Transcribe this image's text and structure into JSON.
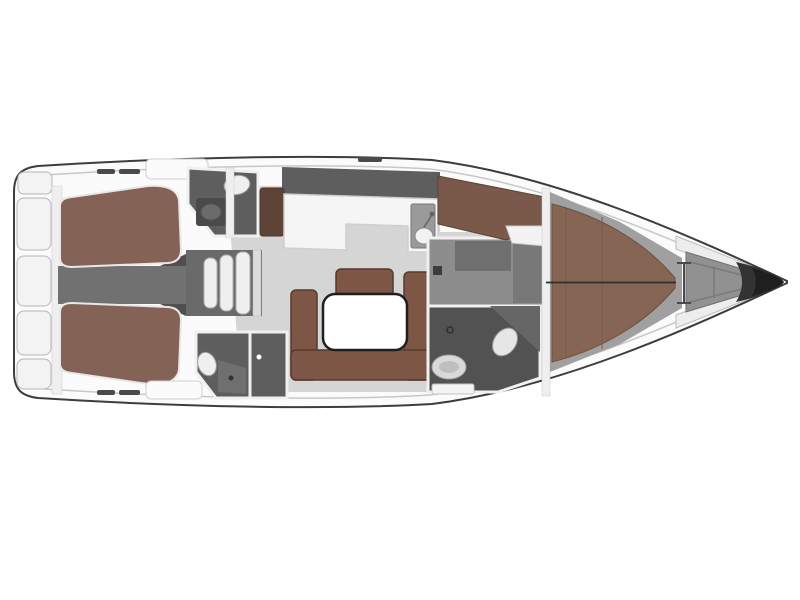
{
  "figure": {
    "kind": "yacht-interior-floorplan",
    "orientation": "bow-right",
    "visible_text": []
  },
  "palette": {
    "background": "#ffffff",
    "hull_fill": "#fbfbfb",
    "hull_outline": "#3d3d3d",
    "deck_line": "#c8c8c8",
    "seat_fill": "#f3f3f3",
    "seat_stroke": "#b5b5b5",
    "floor_gray": "#d5d5d5",
    "corridor_gray": "#717171",
    "stairs_gray": "#6a6a6a",
    "room_dark": "#5e5e5e",
    "room_darker": "#525252",
    "room_medium": "#8d8d8d",
    "inner_dark": "#6f6f6f",
    "berth_brown": "#846356",
    "sofa_brown": "#7d5646",
    "bed_brown": "#876555",
    "band_brown": "#7a584a",
    "bench_brown": "#5e4337",
    "white_furniture": "#f5f5f5",
    "fixture_white": "#efefef",
    "fixture_gray": "#d9d9d9",
    "sink_gray": "#9a9a9a",
    "sink_dark": "#4a4a4a",
    "locker_gray": "#919191",
    "tip_dark": "#333333",
    "tip_core": "#1f1f1f",
    "slot_dark": "#4a4a4a",
    "table_white": "#ffffff",
    "wall_white": "#efefef"
  },
  "regions": [
    {
      "name": "transom-bench-seats",
      "fill": "seat_fill"
    },
    {
      "name": "aft-cabin-port-berth",
      "fill": "berth_brown"
    },
    {
      "name": "aft-cabin-starboard-berth",
      "fill": "berth_brown"
    },
    {
      "name": "engine-corridor",
      "fill": "corridor_gray"
    },
    {
      "name": "companionway-stairs",
      "fill": "stairs_gray"
    },
    {
      "name": "head-aft-port",
      "fill": "room_dark"
    },
    {
      "name": "head-aft-starboard",
      "fill": "room_dark"
    },
    {
      "name": "salon-floor",
      "fill": "floor_gray"
    },
    {
      "name": "galley-counter",
      "fill": "white_furniture"
    },
    {
      "name": "galley-sink",
      "fill": "sink_gray"
    },
    {
      "name": "salon-sofa",
      "fill": "sofa_brown"
    },
    {
      "name": "salon-table",
      "fill": "table_white"
    },
    {
      "name": "wardrobe-forward",
      "fill": "room_medium"
    },
    {
      "name": "head-forward-shower",
      "fill": "room_darker"
    },
    {
      "name": "forward-cabin-berth",
      "fill": "bed_brown"
    },
    {
      "name": "forward-side-berth",
      "fill": "band_brown"
    },
    {
      "name": "bow-anchor-locker",
      "fill": "locker_gray"
    },
    {
      "name": "bow-tip",
      "fill": "tip_dark"
    }
  ]
}
